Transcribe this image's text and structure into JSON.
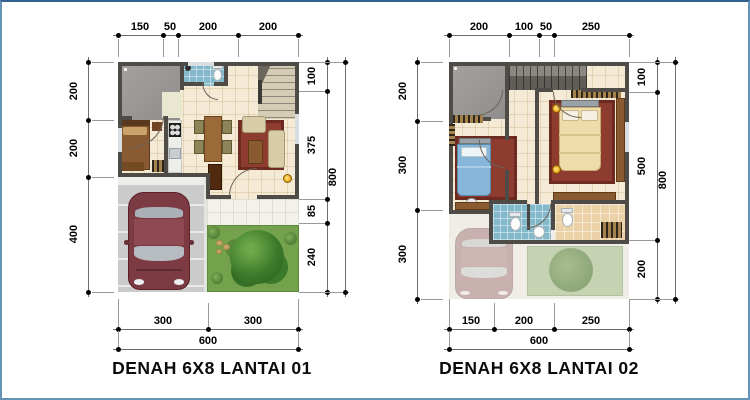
{
  "sheet": {
    "type": "architectural floor plan sheet",
    "unit_system": "centimeters"
  },
  "plans": [
    {
      "title": "DENAH 6X8 LANTAI 01",
      "dims": {
        "top": [
          "150",
          "50",
          "200",
          "200"
        ],
        "left": [
          "200",
          "200",
          "400"
        ],
        "right_inner": [
          "100",
          "375",
          "85",
          "240"
        ],
        "right_outer": "800",
        "bottom": [
          "300",
          "300"
        ],
        "bottom_outer": "600"
      }
    },
    {
      "title": "DENAH 6X8 LANTAI 02",
      "dims": {
        "top": [
          "200",
          "100",
          "50",
          "250"
        ],
        "left": [
          "200",
          "300",
          "300"
        ],
        "right_inner": [
          "100",
          "500",
          "200"
        ],
        "right_outer": "800",
        "bottom": [
          "150",
          "200",
          "250"
        ],
        "bottom_outer": "600"
      }
    }
  ],
  "colors": {
    "frame_border": "#6494b8",
    "wall": "#4f4b47",
    "floor_tile": "#f5ead6",
    "bath_tile": "#84b9cb",
    "roof_gray": "#9d9b99",
    "carport": "#cbcbcb",
    "garden": "#74a14b",
    "car": "#7c3b43",
    "rug": "#8f3c30",
    "wood": "#8a5a30",
    "sofa": "#d8cda8",
    "bed_blue": "#86b7da",
    "bed_cream": "#eedcab",
    "lamp": "#e8a91f"
  }
}
